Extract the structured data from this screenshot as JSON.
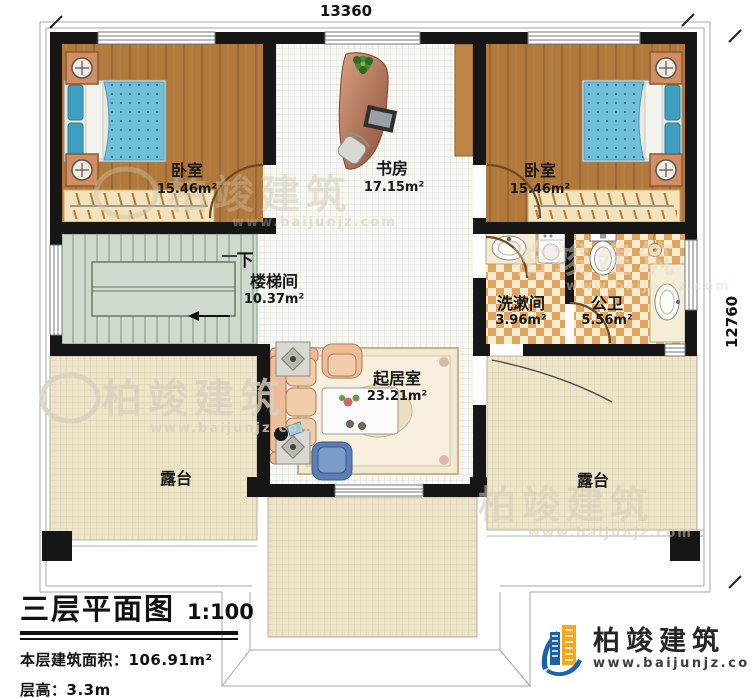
{
  "plan": {
    "kind": "residential floor plan",
    "dimensions": {
      "top": "13360",
      "right": "12760"
    }
  },
  "rooms": [
    {
      "id": "bedroom-left",
      "name": "卧室",
      "area": "15.46m²"
    },
    {
      "id": "study",
      "name": "书房",
      "area": "17.15m²"
    },
    {
      "id": "bedroom-right",
      "name": "卧室",
      "area": "15.46m²"
    },
    {
      "id": "stairwell",
      "name": "楼梯间",
      "area": "10.37m²",
      "direction": "下"
    },
    {
      "id": "washroom",
      "name": "洗漱间",
      "area": "3.96m²"
    },
    {
      "id": "bathroom",
      "name": "公卫",
      "area": "5.56m²"
    },
    {
      "id": "living-room",
      "name": "起居室",
      "area": "23.21m²"
    },
    {
      "id": "terrace-left",
      "name": "露台"
    },
    {
      "id": "terrace-right",
      "name": "露台"
    }
  ],
  "title_block": {
    "title": "三层平面图",
    "scale": "1:100",
    "area_label": "本层建筑面积：",
    "area_value": "106.91m²",
    "height_label": "层高：",
    "height_value": "3.3m"
  },
  "logo": {
    "company": "柏竣建筑",
    "website": "www.baijunjz.com"
  },
  "watermark": {
    "brand": "柏竣建筑",
    "website": "www.baijunjz.com"
  },
  "colors": {
    "wall": "#161616",
    "wood_floor": "#b1793c",
    "bed_quilt": "#6fc0d8",
    "bath_checker": "#e0a55e",
    "terrace_tile": "#ece5ca",
    "stair_floor": "#cfd9ce",
    "sofa": "#edbd9a",
    "logo_blue": "#1b63a8",
    "logo_orange": "#f7a61e"
  }
}
